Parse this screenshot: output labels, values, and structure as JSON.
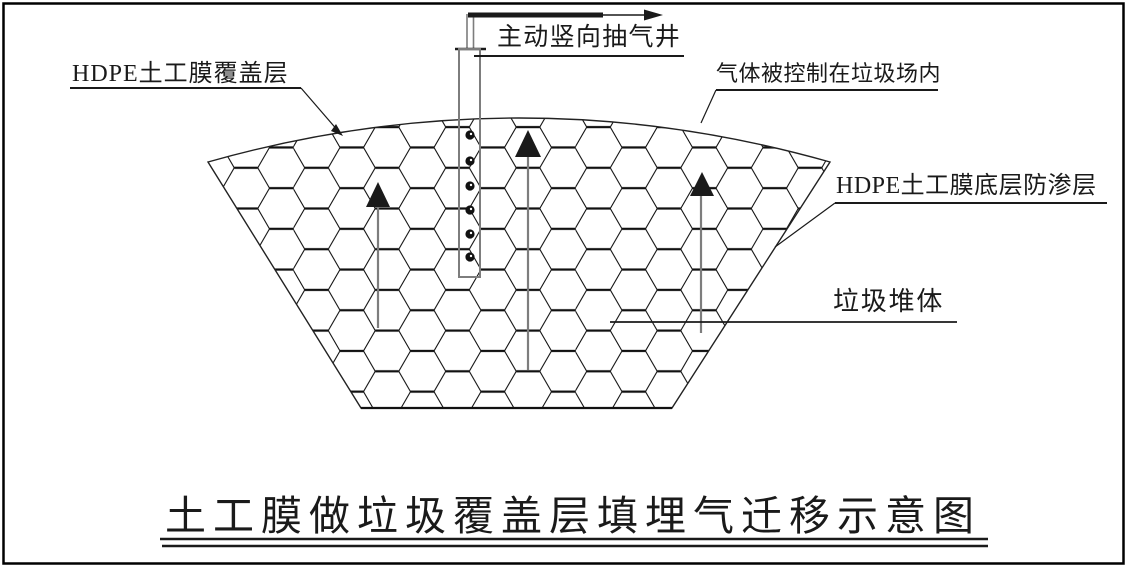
{
  "title": {
    "text": "土工膜做垃圾覆盖层填埋气迁移示意图"
  },
  "labels": {
    "active_well": "主动竖向抽气井",
    "hdpe_cover": "HDPE土工膜覆盖层",
    "gas_contained": "气体被控制在垃圾场内",
    "hdpe_liner": "HDPE土工膜底层防渗层",
    "waste_body": "垃圾堆体"
  },
  "icons": {
    "up_arrow": "gas-flow-up-arrow",
    "right_arrow": "extraction-outlet-right-arrow",
    "leader_arrowhead": "leader-arrowhead"
  },
  "colors": {
    "line": "#1a1a1a",
    "pipe_gray": "#7d7d7d",
    "background": "#ffffff"
  }
}
